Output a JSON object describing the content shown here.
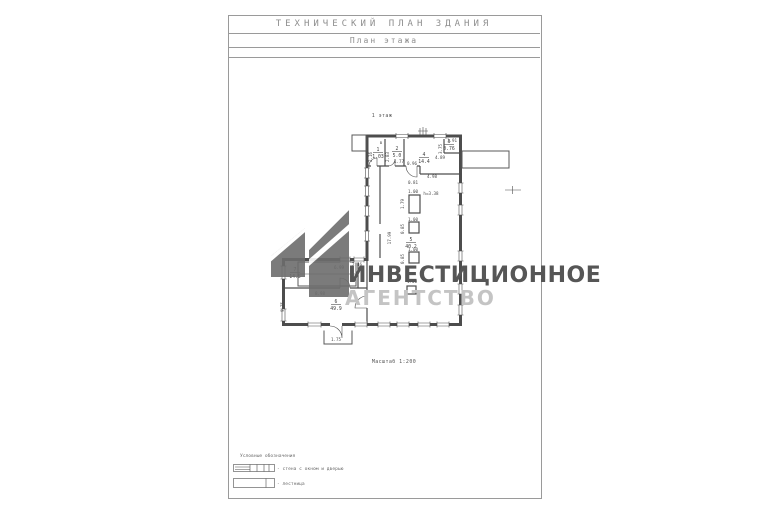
{
  "header": {
    "title": "ТЕХНИЧЕСКИЙ ПЛАН ЗДАНИЯ",
    "subtitle": "План этажа"
  },
  "plan": {
    "floor_label": "1 этаж",
    "scale_label": "Масштаб 1:200",
    "rooms": [
      {
        "num": "1",
        "area": "1.03",
        "x": 378,
        "y": 151
      },
      {
        "num": "2",
        "area": "5.0",
        "x": 397,
        "y": 150
      },
      {
        "num": "3",
        "area": "0.76",
        "x": 449,
        "y": 143
      },
      {
        "num": "4",
        "area": "14.4",
        "x": 424,
        "y": 156
      },
      {
        "num": "5",
        "area": "40.2",
        "x": 411,
        "y": 241
      },
      {
        "num": "6",
        "area": "49.9",
        "x": 336,
        "y": 303
      },
      {
        "num": "7",
        "area": "14.5",
        "x": 295,
        "y": 271
      }
    ],
    "dims": [
      {
        "t": "в",
        "x": 381,
        "y": 144
      },
      {
        "t": "2.16",
        "x": 372,
        "y": 157,
        "rot": 1
      },
      {
        "t": "2.83",
        "x": 389,
        "y": 157,
        "rot": 1
      },
      {
        "t": "1.77",
        "x": 399,
        "y": 163
      },
      {
        "t": "0.96",
        "x": 412,
        "y": 165
      },
      {
        "t": "4.89",
        "x": 440,
        "y": 159
      },
      {
        "t": "1.91",
        "x": 452,
        "y": 142
      },
      {
        "t": "3.75",
        "x": 442,
        "y": 149,
        "rot": 1
      },
      {
        "t": "4.98",
        "x": 432,
        "y": 178
      },
      {
        "t": "0.81",
        "x": 413,
        "y": 184
      },
      {
        "t": "1.00",
        "x": 413,
        "y": 193
      },
      {
        "t": "h=3.38",
        "x": 431,
        "y": 195
      },
      {
        "t": "1.79",
        "x": 404,
        "y": 204,
        "rot": 1
      },
      {
        "t": "1.00",
        "x": 413,
        "y": 221
      },
      {
        "t": "0.85",
        "x": 404,
        "y": 229,
        "rot": 1
      },
      {
        "t": "17.99",
        "x": 391,
        "y": 238,
        "rot": 1
      },
      {
        "t": "1.00",
        "x": 413,
        "y": 251
      },
      {
        "t": "0.85",
        "x": 404,
        "y": 259,
        "rot": 1
      },
      {
        "t": "2.46",
        "x": 357,
        "y": 266
      },
      {
        "t": "6.99",
        "x": 339,
        "y": 269
      },
      {
        "t": "1.00",
        "x": 412,
        "y": 283
      },
      {
        "t": "8.98",
        "x": 320,
        "y": 295
      },
      {
        "t": "9.75",
        "x": 284,
        "y": 307,
        "rot": 1
      },
      {
        "t": "1.75",
        "x": 336,
        "y": 341
      }
    ]
  },
  "watermark": {
    "line1": "ИНВЕСТИЦИОННОЕ",
    "line2": "АГЕНТСТВО"
  },
  "legend": {
    "heading": "Условные обозначения",
    "items": [
      {
        "symbol": "wall-with-window-and-door",
        "label": "- стена с окном и дверью"
      },
      {
        "symbol": "staircase",
        "label": "- лестница"
      }
    ]
  },
  "colors": {
    "line": "#4d4d4d",
    "header_text": "#8e8e8e",
    "watermark_dark": "#565656",
    "watermark_light": "#c4c4c4",
    "logo": "#6d6d6d"
  }
}
